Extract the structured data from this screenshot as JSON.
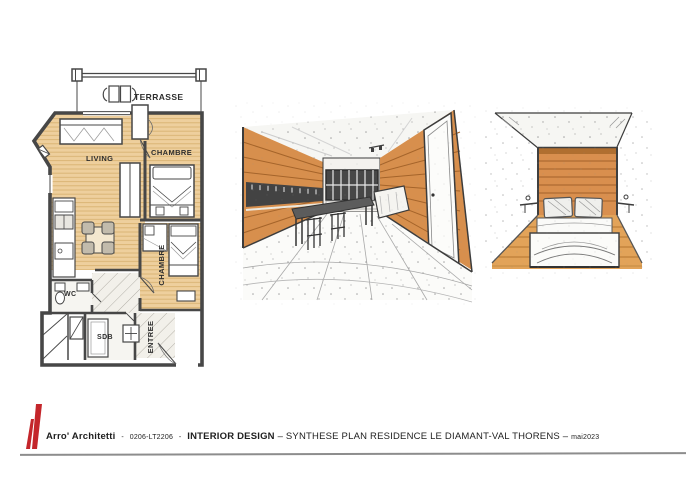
{
  "colors": {
    "accent_red": "#c4262b",
    "plan_wood": "#eecf9d",
    "plan_wood_line": "#d9b272",
    "sketch_wood": "#d78f4d",
    "sketch_wood_line": "#a5642a",
    "bedroom_floor_wood": "#e2a359",
    "ink": "#3c3c3c"
  },
  "floorplan": {
    "labels": {
      "terrasse": "TERRASSE",
      "living": "LIVING",
      "chambre_1": "CHAMBRE",
      "chambre_2": "CHAMBRE",
      "wc": "WC",
      "sdb": "SDB",
      "entree": "ENTREE"
    }
  },
  "footer": {
    "firm": "Arro' Architetti",
    "sep_a": "-",
    "code": "0206-LT2206",
    "sep_b": "-",
    "discipline": "INTERIOR DESIGN",
    "project": "– SYNTHESE PLAN RESIDENCE LE DIAMANT-VAL THORENS –",
    "date": "mai2023"
  }
}
